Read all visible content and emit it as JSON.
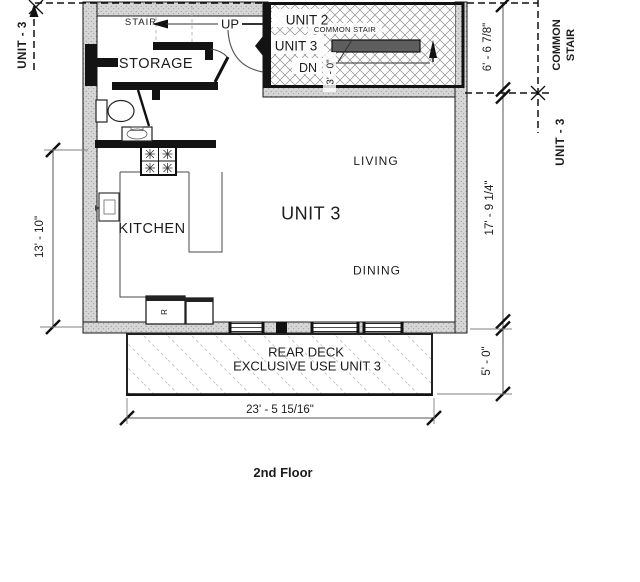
{
  "title": "2nd Floor",
  "plan": {
    "rooms": {
      "unit": "UNIT 3",
      "living": "LIVING",
      "dining": "DINING",
      "kitchen": "KITCHEN",
      "storage": "STORAGE"
    },
    "stair": {
      "label": "STAIR",
      "direction": "UP"
    },
    "common_stair_block": {
      "unit2": "UNIT 2",
      "title": "COMMON STAIR",
      "unit3": "UNIT 3",
      "down": "DN",
      "width": "3' - 0\""
    },
    "deck": {
      "line1": "REAR DECK",
      "line2": "EXCLUSIVE USE UNIT 3"
    },
    "appliances": {
      "refrigerator": "R"
    }
  },
  "dimensions": {
    "stair_depth": "6' - 6 7/8\"",
    "unit_depth": "17' - 9 1/4\"",
    "deck_depth": "5' - 0\"",
    "unit_left": "13' - 10\"",
    "deck_width": "23' - 5 15/16\""
  },
  "boundaries": {
    "left_unit": "UNIT - 3",
    "right_common_1": "COMMON",
    "right_common_2": "STAIR",
    "right_unit": "UNIT - 3"
  },
  "colors": {
    "ink": "#1a1a1a",
    "wall_fill": "#d6d6d6",
    "wall_stipple": "#8a8a8a",
    "stair_hatch": "#8d8d8d",
    "deck_hatch": "#c0c0c0"
  }
}
